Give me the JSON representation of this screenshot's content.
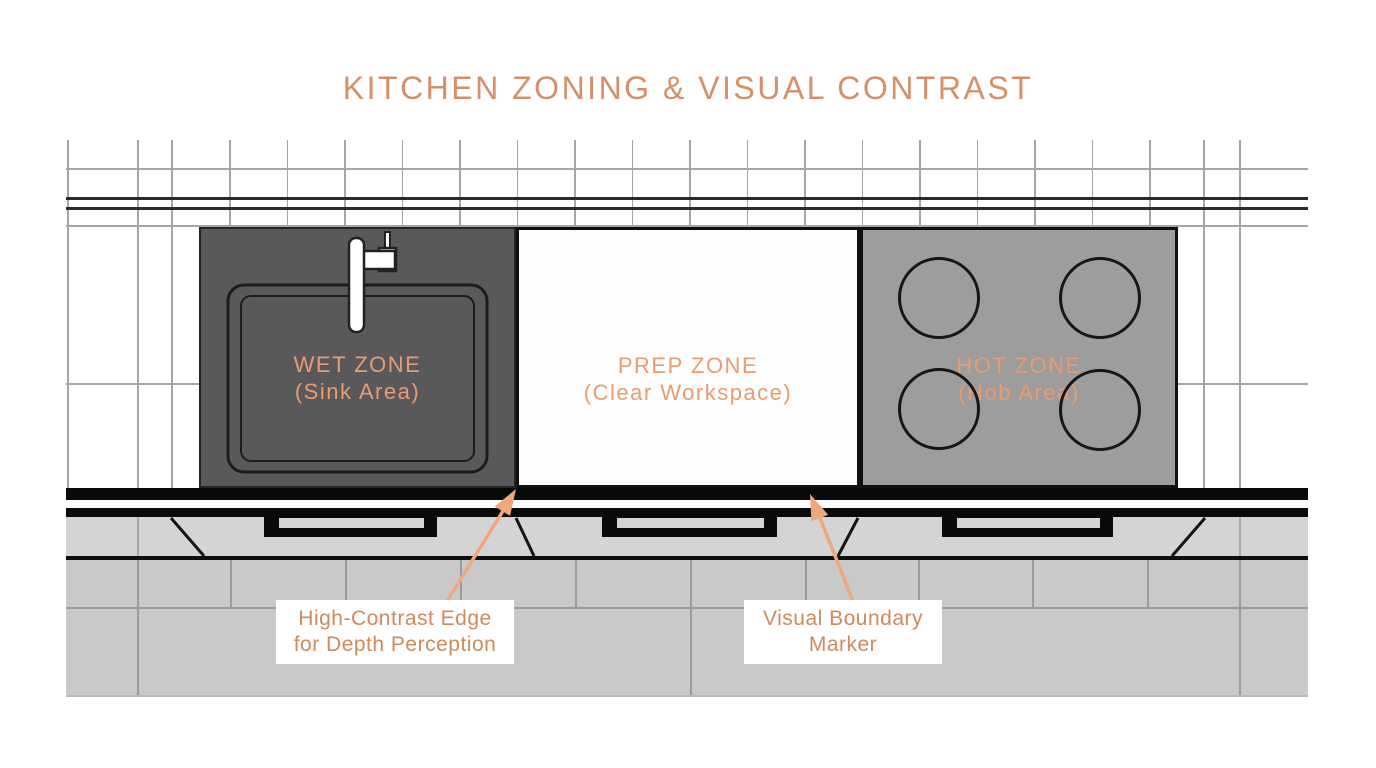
{
  "title": "KITCHEN ZONING & VISUAL CONTRAST",
  "zones": [
    {
      "id": "wet",
      "label": "WET ZONE",
      "sublabel": "(Sink Area)"
    },
    {
      "id": "prep",
      "label": "PREP ZONE",
      "sublabel": "(Clear Workspace)"
    },
    {
      "id": "hot",
      "label": "HOT ZONE",
      "sublabel": "(Hob Area)"
    }
  ],
  "annotations": [
    {
      "line1": "High-Contrast Edge",
      "line2": "for Depth Perception"
    },
    {
      "line1": "Visual Boundary",
      "line2": "Marker"
    }
  ],
  "colors": {
    "title_text": "#d5906a",
    "zone_label_text": "#e89c6f",
    "annotation_text": "#cf8a5c",
    "arrow": "#efa87c",
    "wet_zone_fill": "#59595b",
    "prep_zone_fill": "#fdfdfd",
    "hot_zone_fill": "#9d9d9d",
    "cabinet_fill": "#d4d4d4",
    "brick_fill": "#c9c9c9",
    "grid_line": "#a6a6a6",
    "dark_line": "#111111"
  }
}
